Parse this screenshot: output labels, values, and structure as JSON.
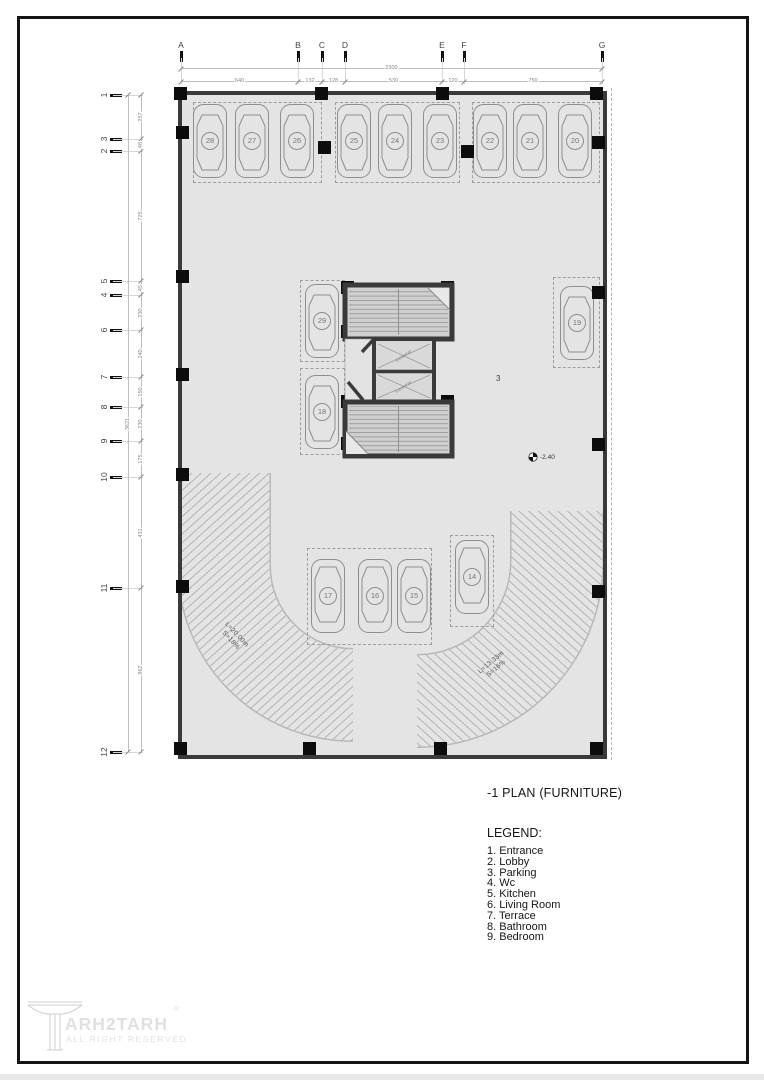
{
  "page": {
    "title": "-1 PLAN (FURNITURE)",
    "legend_title": "LEGEND:",
    "legend_items": [
      "1. Entrance",
      "2. Lobby",
      "3. Parking",
      "4. Wc",
      "5. Kitchen",
      "6. Living Room",
      "7. Terrace",
      "8. Bathroom",
      "9. Bedroom"
    ]
  },
  "grid": {
    "top_letters": [
      "A",
      "B",
      "C",
      "D",
      "E",
      "F",
      "G"
    ],
    "top_overall_dim": "2300",
    "top_segment_dims": [
      "640",
      "132",
      "128",
      "530",
      "120",
      "750"
    ],
    "left_numbers": [
      "1",
      "3",
      "2",
      "5",
      "4",
      "6",
      "7",
      "8",
      "9",
      "10",
      "11",
      "12"
    ],
    "left_overall_dim": "3621",
    "left_segment_dims": [
      "257",
      "48",
      "725",
      "45",
      "230",
      "240",
      "150",
      "230",
      "175",
      "431",
      "862"
    ]
  },
  "plan": {
    "zone_label": "3",
    "level_marker": "-2.40",
    "elevator_label": "ELEVATOR",
    "ramp_left_l1": "L=20.00m",
    "ramp_left_l2": "S=18%",
    "ramp_right_l1": "L=13.33m",
    "ramp_right_l2": "S=16%",
    "cars": [
      "28",
      "27",
      "26",
      "25",
      "24",
      "23",
      "22",
      "21",
      "20",
      "29",
      "19",
      "18",
      "17",
      "16",
      "15",
      "14"
    ]
  },
  "logo": {
    "name": "ARH2TARH",
    "reg": "®",
    "tagline": "ALL RIGHT RESERVED"
  },
  "colors": {
    "floor": "#e4e4e4",
    "wall": "#3a3a3a",
    "column": "#0c0c0c",
    "stair_fill": "#cfcfcf",
    "dash": "#9e9e9e",
    "frame": "#141414"
  }
}
